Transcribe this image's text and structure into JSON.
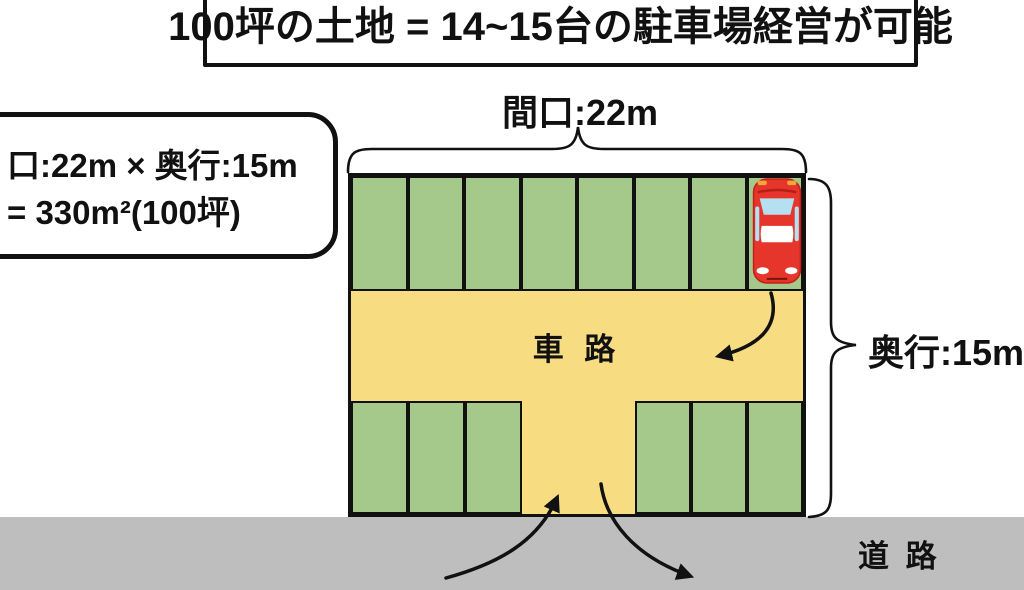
{
  "header_box": {
    "text": "100坪の土地 = 14~15台の駐車場経営が可能"
  },
  "area_box": {
    "line1": "口:22m × 奥行:15m",
    "line2": "= 330m²(100坪)"
  },
  "labels": {
    "frontage": "間口:22m",
    "depth": "奥行:15m",
    "driveway": "車 路",
    "road": "道 路"
  },
  "parking": {
    "top_row_stalls": 8,
    "bottom_left_stalls": 3,
    "bottom_right_stalls": 3,
    "car": "red-car-in-rightmost-top-stall"
  },
  "colors": {
    "stall_green": "#a5c98b",
    "driveway_yellow": "#f8dc82",
    "road_gray": "#bebebe",
    "outline": "#111111",
    "car_red": "#e6352b",
    "car_red_dark": "#c22018",
    "car_glass_blue": "#b5e0f2",
    "headlight_orange": "#f2a73d"
  }
}
